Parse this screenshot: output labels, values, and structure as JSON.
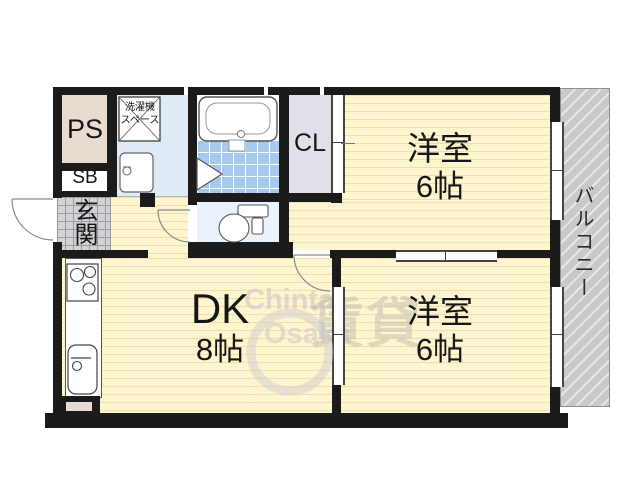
{
  "rooms": {
    "ps": "PS",
    "sb": "SB",
    "genkan": "玄関",
    "laundry_line1": "洗濯機",
    "laundry_line2": "スペース",
    "closet": "CL",
    "western_top_name": "洋室",
    "western_top_size": "6帖",
    "western_bottom_name": "洋室",
    "western_bottom_size": "6帖",
    "dk_name": "DK",
    "dk_size": "8帖",
    "balcony": "バルコニー"
  },
  "watermark": {
    "line1": "Chintai",
    "line2": "Osaka",
    "kanji": "賃貸"
  },
  "colors": {
    "wall": "#1b1b1b",
    "floor_yellow": "#fdf5cf",
    "bath_tile": "#a6c9ec",
    "washroom": "#dfeaf7",
    "toilet_floor": "#eaf2fb",
    "closet": "#e3dfe8",
    "ps": "#e8dcd0",
    "genkan_tile": "#d2d2d6",
    "balcony": "#c9c9c9"
  }
}
